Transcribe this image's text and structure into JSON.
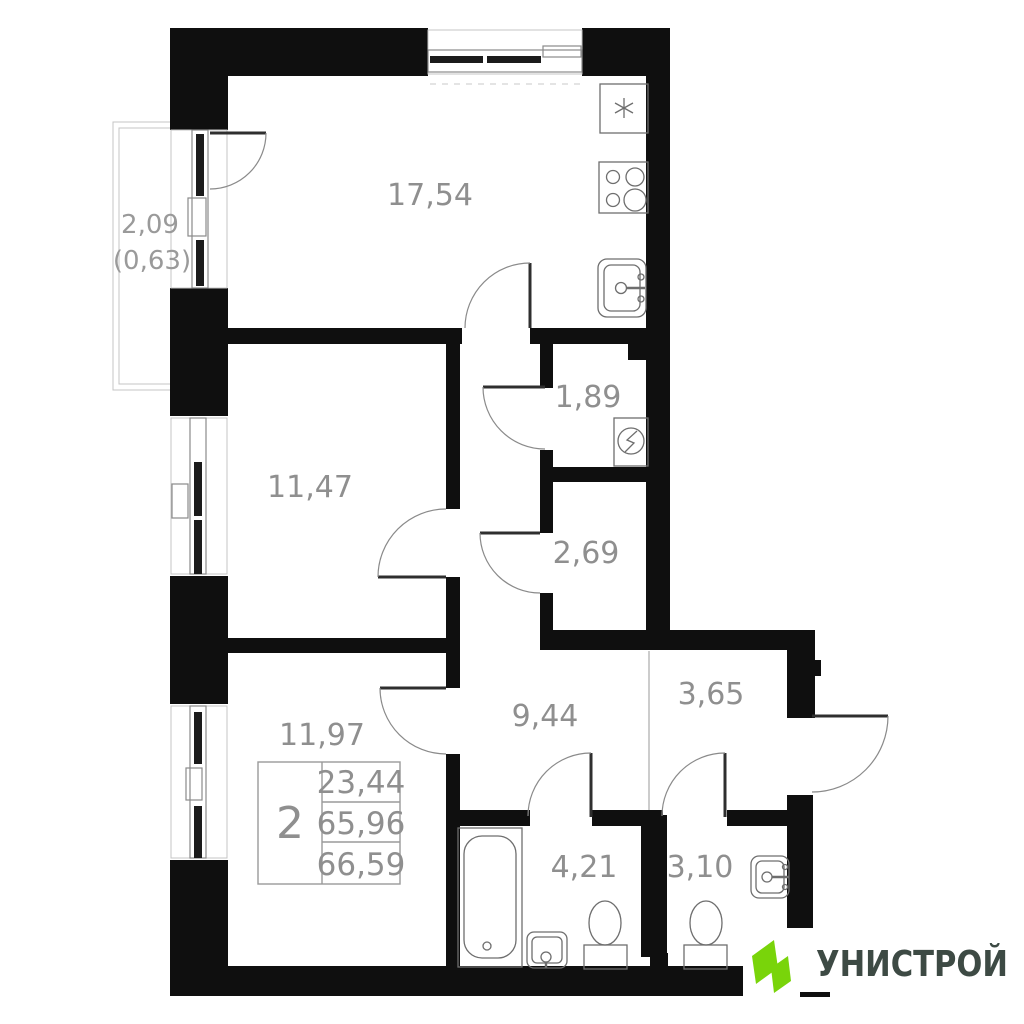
{
  "plan": {
    "balcony": {
      "area": "2,09",
      "area_weighted": "(0,63)"
    },
    "rooms": {
      "kitchen_living": "17,54",
      "room_a": "11,47",
      "hallway": "1,89",
      "storage": "2,69",
      "room_b": "11,97",
      "corridor": "9,44",
      "entry_hall": "3,65",
      "bathroom": "4,21",
      "wc": "3,10"
    },
    "info_stamp": {
      "rooms_count": "2",
      "area_living": "23,44",
      "area_apartment": "65,96",
      "area_total": "66,59"
    }
  },
  "logo": {
    "brand": "УНИСТРОЙ"
  },
  "colors": {
    "wall": "#0f0f0f",
    "label": "#8f8f8f",
    "logo_green": "#79d40a",
    "logo_text": "#3d4a44"
  }
}
